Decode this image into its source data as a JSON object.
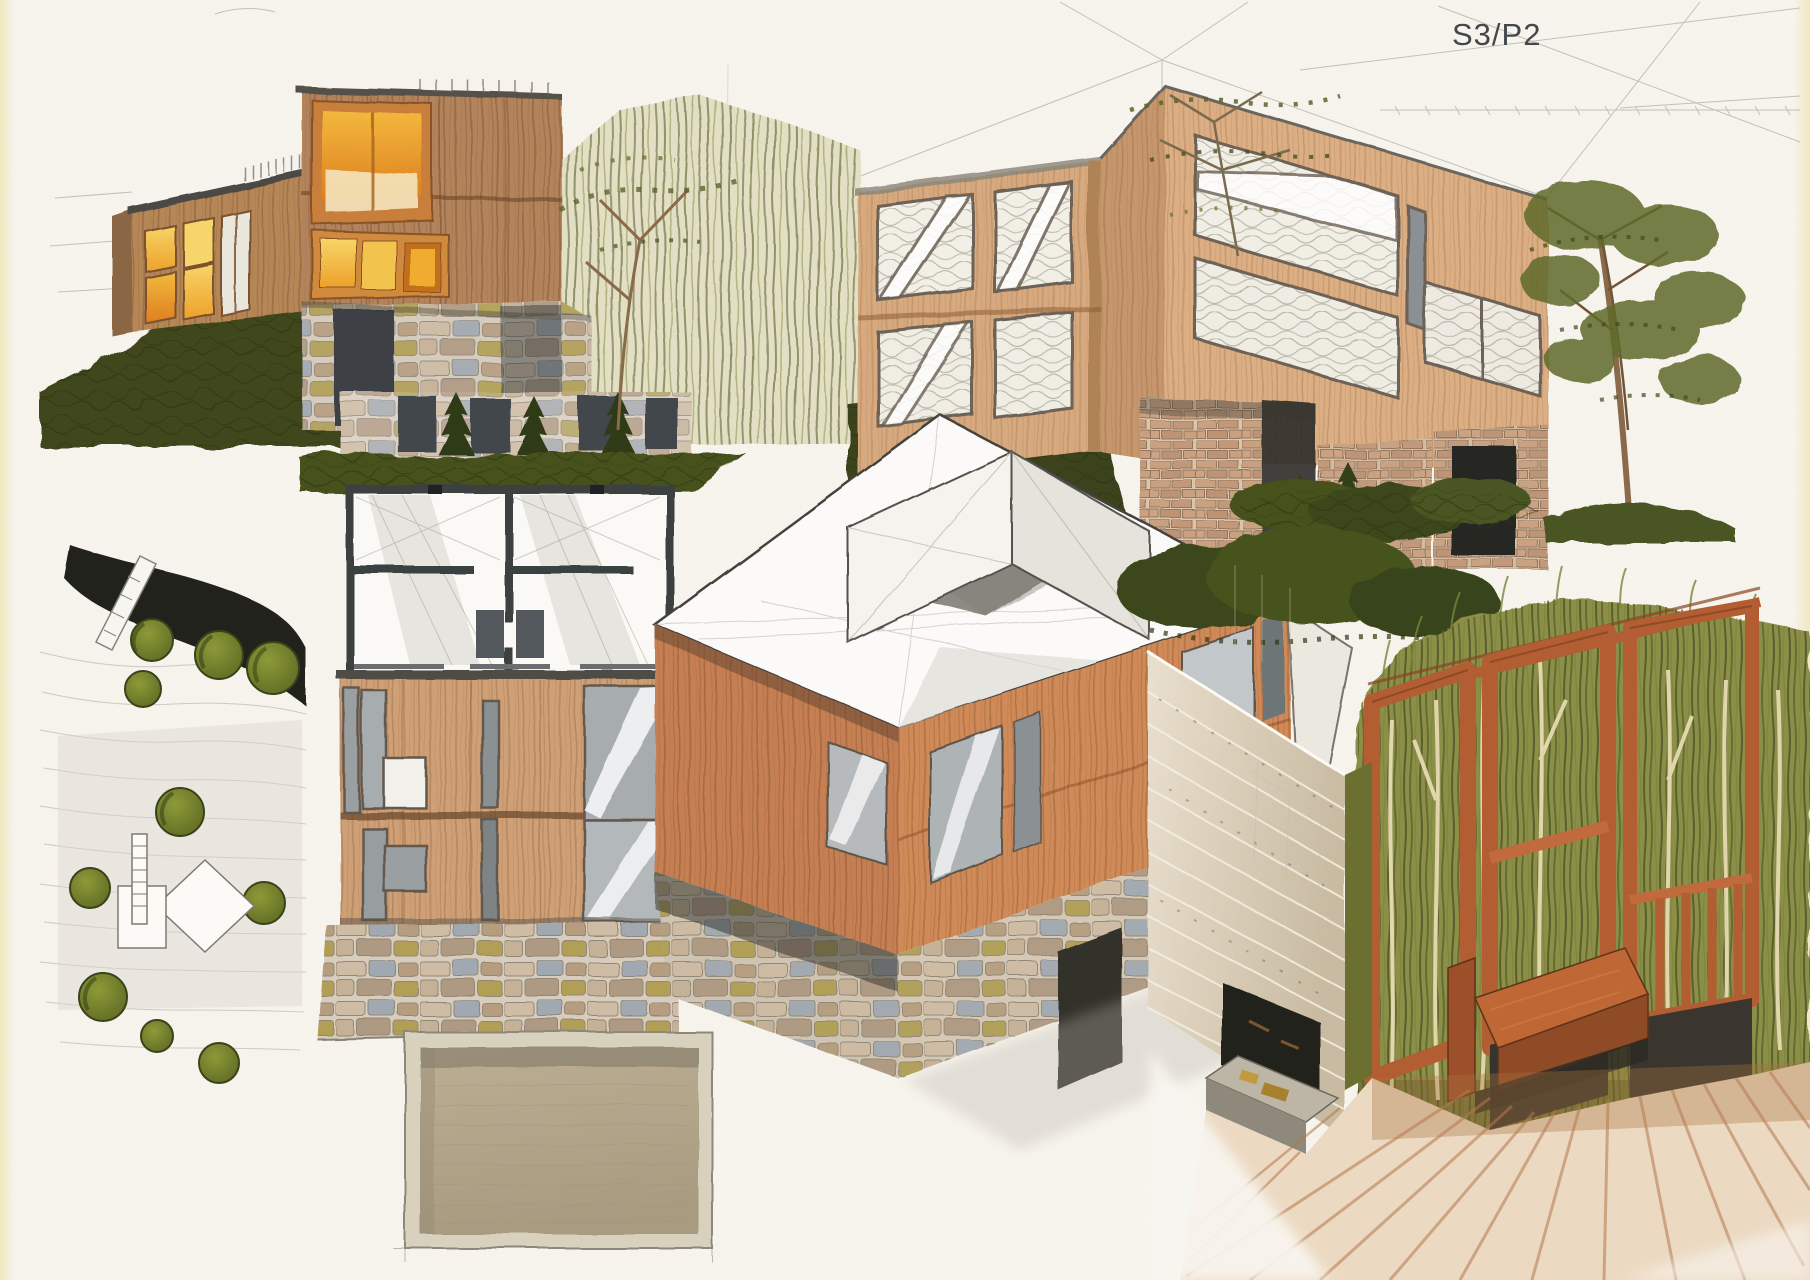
{
  "sheet": {
    "code": "S3/P2",
    "code_color": "#43474b",
    "paper": "#f8f5ee",
    "paper_edge": "#f1e7bd"
  },
  "palette": {
    "wood_dark": "#b3845c",
    "wood_light": "#d7a97e",
    "wood_axon": "#c67f52",
    "wood_frame_sienna": "#b25d32",
    "window_glow": "#f0ac2e",
    "window_glow_pale": "#f6d66b",
    "window_gray": "#a7acae",
    "vegetation_dark": "#3f471c",
    "vegetation_olive": "#6e7433",
    "tree_plan_green": "#6f7a2a",
    "stone_light": "#cbb9a3",
    "stone_joint": "#7a6f5f",
    "brick": "#c99f7e",
    "pencil_gray": "#8f8d86",
    "plan_wall": "#3b3f41",
    "river_black": "#20241f",
    "roof_panel_taupe": "#b2a68c",
    "floor_wood": "#c08257"
  }
}
